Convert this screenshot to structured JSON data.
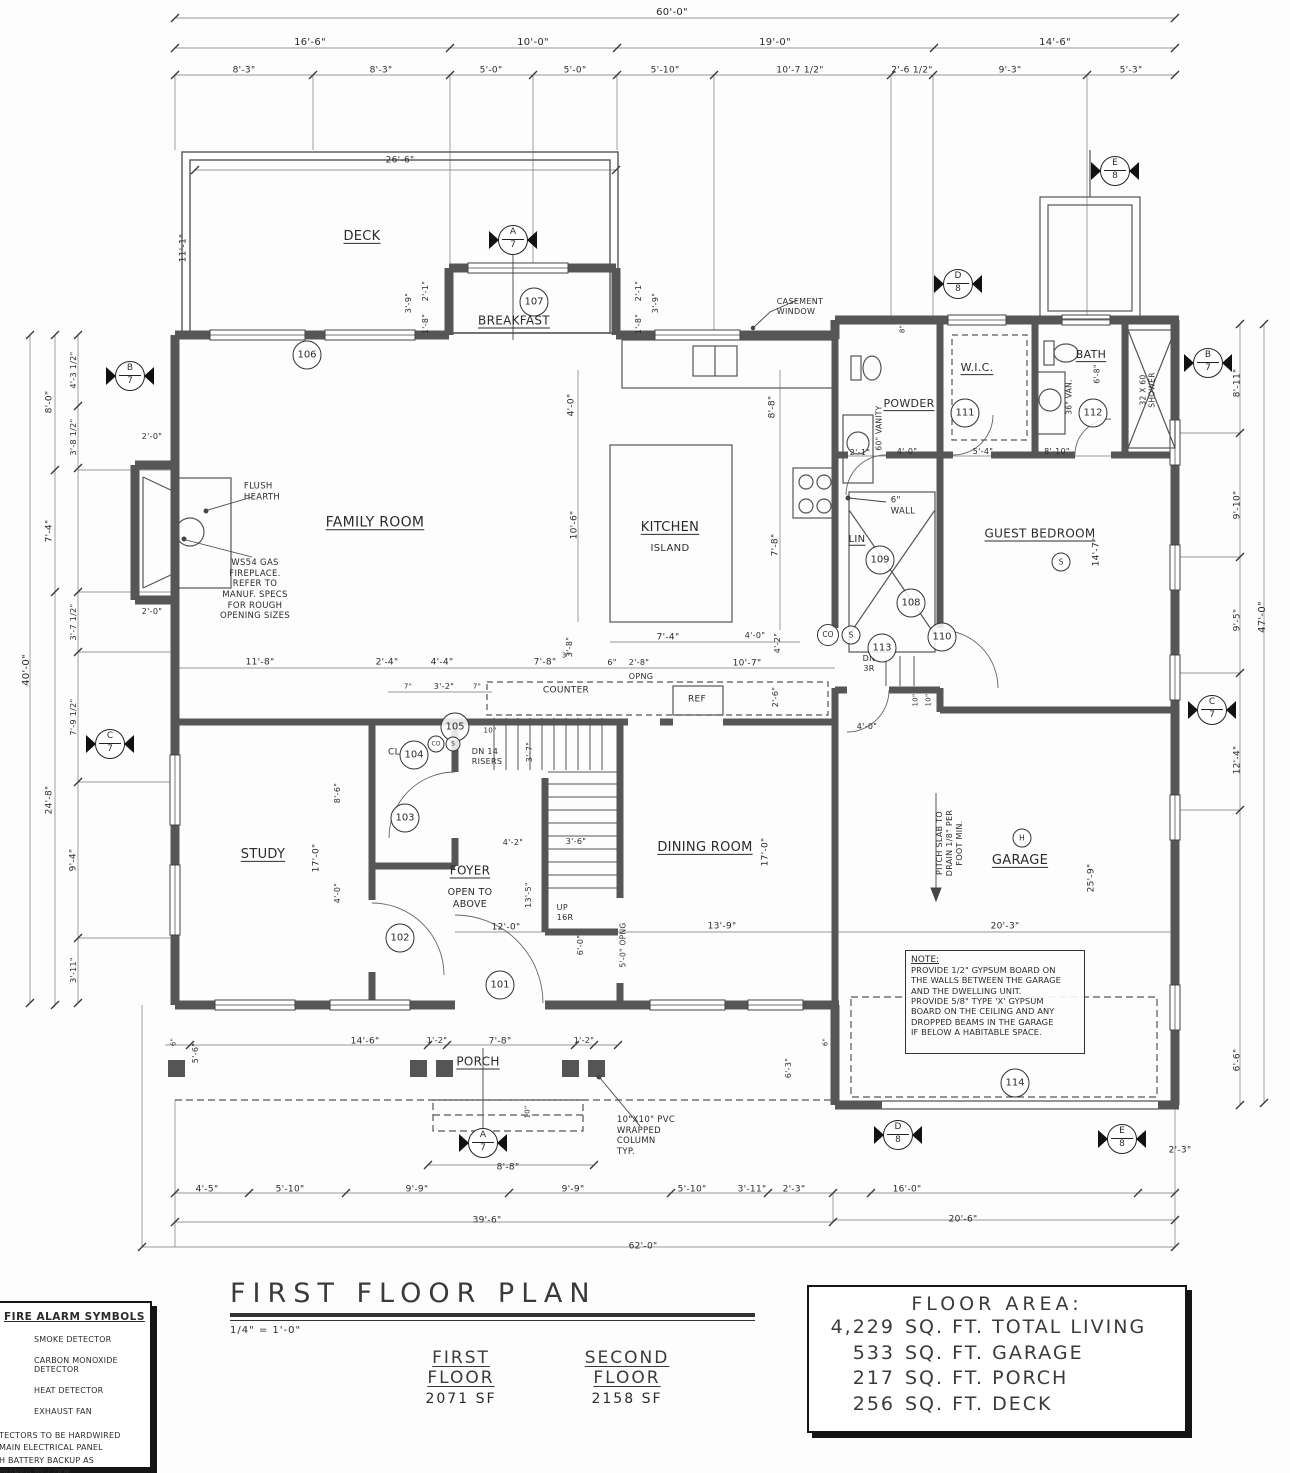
{
  "title_block": {
    "title": "FIRST FLOOR PLAN",
    "scale": "1/4\" = 1'-0\"",
    "first_floor_label": "FIRST FLOOR",
    "first_floor_area": "2071 SF",
    "second_floor_label": "SECOND FLOOR",
    "second_floor_area": "2158 SF"
  },
  "floor_area": {
    "title": "FLOOR AREA:",
    "rows": [
      {
        "qty": "4,229",
        "label": "SQ. FT. TOTAL LIVING"
      },
      {
        "qty": "533",
        "label": "SQ. FT. GARAGE"
      },
      {
        "qty": "217",
        "label": "SQ. FT. PORCH"
      },
      {
        "qty": "256",
        "label": "SQ. FT. DECK"
      }
    ]
  },
  "fire_legend": {
    "title": "FIRE ALARM SYMBOLS",
    "items": [
      "SMOKE DETECTOR",
      "CARBON MONOXIDE DETECTOR",
      "HEAT DETECTOR",
      "EXHAUST FAN"
    ],
    "note_lines": [
      "TECTORS TO BE HARDWIRED",
      " MAIN ELECTRICAL PANEL",
      "H BATTERY BACKUP AS",
      "QUIRED BY CODE."
    ]
  },
  "note_box": {
    "title": "NOTE:",
    "body": "PROVIDE 1/2\" GYPSUM BOARD ON\nTHE WALLS BETWEEN THE GARAGE\nAND THE DWELLING UNIT.\nPROVIDE 5/8\" TYPE 'X' GYPSUM\nBOARD ON THE CEILING AND ANY\nDROPPED BEAMS IN THE GARAGE\nIF BELOW A HABITABLE SPACE."
  },
  "door_tags": [
    {
      "t": "101",
      "x": 500,
      "y": 985
    },
    {
      "t": "102",
      "x": 400,
      "y": 938
    },
    {
      "t": "103",
      "x": 405,
      "y": 818
    },
    {
      "t": "104",
      "x": 414,
      "y": 755
    },
    {
      "t": "105",
      "x": 455,
      "y": 727
    },
    {
      "t": "106",
      "x": 307,
      "y": 355
    },
    {
      "t": "107",
      "x": 534,
      "y": 302
    },
    {
      "t": "108",
      "x": 911,
      "y": 603
    },
    {
      "t": "109",
      "x": 880,
      "y": 560
    },
    {
      "t": "110",
      "x": 942,
      "y": 637
    },
    {
      "t": "111",
      "x": 965,
      "y": 413
    },
    {
      "t": "112",
      "x": 1093,
      "y": 413
    },
    {
      "t": "113",
      "x": 882,
      "y": 648
    },
    {
      "t": "114",
      "x": 1015,
      "y": 1083
    }
  ],
  "symbol_tags": [
    {
      "t": "CO",
      "x": 828,
      "y": 635,
      "d": 20,
      "f": 7.5
    },
    {
      "t": "S",
      "x": 851,
      "y": 635,
      "d": 17,
      "f": 7.5
    },
    {
      "t": "S",
      "x": 1061,
      "y": 562,
      "d": 17,
      "f": 7.5
    },
    {
      "t": "H",
      "x": 1022,
      "y": 838,
      "d": 17,
      "f": 7.5
    },
    {
      "t": "CO",
      "x": 436,
      "y": 744,
      "d": 15,
      "f": 6
    },
    {
      "t": "S",
      "x": 453,
      "y": 744,
      "d": 13,
      "f": 6
    }
  ],
  "section_markers": [
    {
      "l": "A",
      "n": "7",
      "x": 513,
      "y": 240
    },
    {
      "l": "A",
      "n": "7",
      "x": 483,
      "y": 1143
    },
    {
      "l": "B",
      "n": "7",
      "x": 130,
      "y": 376
    },
    {
      "l": "B",
      "n": "7",
      "x": 1208,
      "y": 363
    },
    {
      "l": "C",
      "n": "7",
      "x": 110,
      "y": 744
    },
    {
      "l": "C",
      "n": "7",
      "x": 1212,
      "y": 710
    },
    {
      "l": "D",
      "n": "8",
      "x": 958,
      "y": 284
    },
    {
      "l": "D",
      "n": "8",
      "x": 898,
      "y": 1135
    },
    {
      "l": "E",
      "n": "8",
      "x": 1115,
      "y": 171
    },
    {
      "l": "E",
      "n": "8",
      "x": 1122,
      "y": 1139
    }
  ],
  "labels": [
    {
      "t": "60'-0\"",
      "x": 672,
      "y": 13
    },
    {
      "t": "16'-6\"",
      "x": 310,
      "y": 43
    },
    {
      "t": "10'-0\"",
      "x": 533,
      "y": 43
    },
    {
      "t": "19'-0\"",
      "x": 775,
      "y": 43
    },
    {
      "t": "14'-6\"",
      "x": 1055,
      "y": 43
    },
    {
      "t": "8'-3\"",
      "x": 244,
      "y": 71,
      "s": 9
    },
    {
      "t": "8'-3\"",
      "x": 381,
      "y": 71,
      "s": 9
    },
    {
      "t": "5'-0\"",
      "x": 491,
      "y": 71,
      "s": 9
    },
    {
      "t": "5'-0\"",
      "x": 575,
      "y": 71,
      "s": 9
    },
    {
      "t": "5'-10\"",
      "x": 665,
      "y": 71,
      "s": 9
    },
    {
      "t": "10'-7 1/2\"",
      "x": 800,
      "y": 71,
      "s": 9
    },
    {
      "t": "2'-6 1/2\"",
      "x": 912,
      "y": 71,
      "s": 9
    },
    {
      "t": "9'-3\"",
      "x": 1010,
      "y": 71,
      "s": 9
    },
    {
      "t": "5'-3\"",
      "x": 1131,
      "y": 71,
      "s": 9
    },
    {
      "t": "26'-6\"",
      "x": 400,
      "y": 161,
      "s": 9
    },
    {
      "t": "DECK",
      "x": 362,
      "y": 237,
      "s": 13,
      "u": 1
    },
    {
      "t": "11'-1\"",
      "x": 184,
      "y": 248,
      "r": -90,
      "s": 9
    },
    {
      "t": "3'-9\"",
      "x": 409,
      "y": 303,
      "r": -90,
      "s": 8
    },
    {
      "t": "2'-1\"",
      "x": 426,
      "y": 291,
      "r": -90,
      "s": 8
    },
    {
      "t": "1'-8\"",
      "x": 426,
      "y": 324,
      "r": -90,
      "s": 8
    },
    {
      "t": "2'-1\"",
      "x": 639,
      "y": 291,
      "r": -90,
      "s": 8
    },
    {
      "t": "3'-9\"",
      "x": 656,
      "y": 303,
      "r": -90,
      "s": 8
    },
    {
      "t": "1'-8\"",
      "x": 639,
      "y": 324,
      "r": -90,
      "s": 8
    },
    {
      "t": "BREAKFAST",
      "x": 514,
      "y": 321,
      "s": 12,
      "u": 1
    },
    {
      "t": "CASEMENT\nWINDOW",
      "x": 800,
      "y": 307,
      "s": 8,
      "a": "left"
    },
    {
      "t": "8\"",
      "x": 903,
      "y": 329,
      "r": -90,
      "s": 7
    },
    {
      "t": "4'-3 1/2\"",
      "x": 74,
      "y": 370,
      "r": -90,
      "s": 8
    },
    {
      "t": "8'-0\"",
      "x": 50,
      "y": 402,
      "r": -90,
      "s": 9
    },
    {
      "t": "3'-8 1/2\"",
      "x": 74,
      "y": 437,
      "r": -90,
      "s": 8
    },
    {
      "t": "7'-4\"",
      "x": 50,
      "y": 531,
      "r": -90,
      "s": 9
    },
    {
      "t": "3'-7 1/2\"",
      "x": 74,
      "y": 622,
      "r": -90,
      "s": 8
    },
    {
      "t": "7'-9 1/2\"",
      "x": 74,
      "y": 717,
      "r": -90,
      "s": 8
    },
    {
      "t": "24'-8\"",
      "x": 50,
      "y": 800,
      "r": -90,
      "s": 9
    },
    {
      "t": "9'-4\"",
      "x": 74,
      "y": 860,
      "r": -90,
      "s": 9
    },
    {
      "t": "3'-11\"",
      "x": 74,
      "y": 970,
      "r": -90,
      "s": 8
    },
    {
      "t": "40'-0\"",
      "x": 27,
      "y": 670,
      "r": -90,
      "s": 10
    },
    {
      "t": "2'-0\"",
      "x": 152,
      "y": 437,
      "s": 8
    },
    {
      "t": "2'-0\"",
      "x": 152,
      "y": 612,
      "s": 8
    },
    {
      "t": "FAMILY ROOM",
      "x": 375,
      "y": 523,
      "s": 14,
      "u": 1
    },
    {
      "t": "FLUSH\nHEARTH",
      "x": 262,
      "y": 492,
      "s": 8.5,
      "a": "left"
    },
    {
      "t": "WS54 GAS\nFIREPLACE.\nREFER TO\nMANUF. SPECS\nFOR ROUGH\nOPENING SIZES",
      "x": 255,
      "y": 590,
      "s": 8.5
    },
    {
      "t": "11'-8\"",
      "x": 260,
      "y": 663,
      "s": 9
    },
    {
      "t": "2'-4\"",
      "x": 387,
      "y": 663,
      "s": 9
    },
    {
      "t": "4'-4\"",
      "x": 442,
      "y": 663,
      "s": 9
    },
    {
      "t": "7'-8\"",
      "x": 545,
      "y": 663,
      "s": 9
    },
    {
      "t": "3\"",
      "x": 566,
      "y": 656,
      "s": 7
    },
    {
      "t": "6\"",
      "x": 612,
      "y": 663,
      "s": 8
    },
    {
      "t": "2'-8\"",
      "x": 639,
      "y": 663,
      "s": 8
    },
    {
      "t": "OPNG",
      "x": 641,
      "y": 677,
      "s": 8
    },
    {
      "t": "10'-7\"",
      "x": 747,
      "y": 664,
      "s": 9
    },
    {
      "t": "2'-6\"",
      "x": 776,
      "y": 697,
      "r": -90,
      "s": 8
    },
    {
      "t": "7\"",
      "x": 408,
      "y": 687,
      "s": 7
    },
    {
      "t": "3'-2\"",
      "x": 444,
      "y": 687,
      "s": 8
    },
    {
      "t": "7\"",
      "x": 477,
      "y": 687,
      "s": 7
    },
    {
      "t": "COUNTER",
      "x": 566,
      "y": 691,
      "s": 9
    },
    {
      "t": "KITCHEN",
      "x": 670,
      "y": 528,
      "s": 13,
      "u": 1
    },
    {
      "t": "ISLAND",
      "x": 670,
      "y": 549,
      "s": 10
    },
    {
      "t": "4'-0\"",
      "x": 572,
      "y": 405,
      "r": -90,
      "s": 9
    },
    {
      "t": "10'-6\"",
      "x": 575,
      "y": 525,
      "r": -90,
      "s": 9
    },
    {
      "t": "3'-8\"",
      "x": 570,
      "y": 647,
      "r": -90,
      "s": 8
    },
    {
      "t": "7'-4\"",
      "x": 668,
      "y": 638,
      "s": 9
    },
    {
      "t": "4'-0\"",
      "x": 755,
      "y": 636,
      "s": 8
    },
    {
      "t": "4'-2\"",
      "x": 778,
      "y": 643,
      "r": -90,
      "s": 8
    },
    {
      "t": "8'-8\"",
      "x": 773,
      "y": 407,
      "r": -90,
      "s": 9
    },
    {
      "t": "7'-8\"",
      "x": 776,
      "y": 545,
      "r": -90,
      "s": 9
    },
    {
      "t": "6\"\nWALL",
      "x": 903,
      "y": 506,
      "s": 8.5,
      "a": "left"
    },
    {
      "t": "LIN",
      "x": 857,
      "y": 540,
      "s": 10,
      "u": 1
    },
    {
      "t": "DN\n3R",
      "x": 869,
      "y": 664,
      "s": 8
    },
    {
      "t": "REF",
      "x": 697,
      "y": 700,
      "s": 9
    },
    {
      "t": "POWDER",
      "x": 909,
      "y": 404,
      "s": 11,
      "u": 1
    },
    {
      "t": "60\" VANITY",
      "x": 879,
      "y": 428,
      "r": -90,
      "s": 7.5
    },
    {
      "t": "2'-1\"",
      "x": 860,
      "y": 453,
      "s": 8
    },
    {
      "t": "4'-0\"",
      "x": 907,
      "y": 452,
      "s": 8
    },
    {
      "t": "W.I.C.",
      "x": 977,
      "y": 368,
      "s": 11,
      "u": 1
    },
    {
      "t": "5'-4\"",
      "x": 983,
      "y": 452,
      "s": 8
    },
    {
      "t": "8'-10\"",
      "x": 1057,
      "y": 452,
      "s": 8
    },
    {
      "t": "BATH",
      "x": 1091,
      "y": 355,
      "s": 11,
      "u": 1
    },
    {
      "t": "36\" VAN.",
      "x": 1069,
      "y": 397,
      "r": -90,
      "s": 7.5
    },
    {
      "t": "6'-8\"",
      "x": 1097,
      "y": 374,
      "r": -90,
      "s": 7.5
    },
    {
      "t": "32 X 60\nSHOWER",
      "x": 1148,
      "y": 390,
      "r": -90,
      "s": 7.5
    },
    {
      "t": "GUEST BEDROOM",
      "x": 1040,
      "y": 534,
      "s": 12,
      "u": 1
    },
    {
      "t": "14'-7\"",
      "x": 1097,
      "y": 552,
      "r": -90,
      "s": 9
    },
    {
      "t": "8'-11\"",
      "x": 1238,
      "y": 383,
      "r": -90,
      "s": 9
    },
    {
      "t": "9'-10\"",
      "x": 1238,
      "y": 505,
      "r": -90,
      "s": 9
    },
    {
      "t": "9'-5\"",
      "x": 1238,
      "y": 620,
      "r": -90,
      "s": 9
    },
    {
      "t": "12'-4\"",
      "x": 1238,
      "y": 760,
      "r": -90,
      "s": 9
    },
    {
      "t": "6'-6\"",
      "x": 1238,
      "y": 1060,
      "r": -90,
      "s": 9
    },
    {
      "t": "47'-0\"",
      "x": 1263,
      "y": 617,
      "r": -90,
      "s": 10
    },
    {
      "t": "2'-3\"",
      "x": 1180,
      "y": 1151,
      "s": 9
    },
    {
      "t": "4'-0\"",
      "x": 867,
      "y": 727,
      "s": 8
    },
    {
      "t": "10\"",
      "x": 916,
      "y": 700,
      "r": -90,
      "s": 7
    },
    {
      "t": "10\"",
      "x": 929,
      "y": 700,
      "r": -90,
      "s": 7
    },
    {
      "t": "10\"",
      "x": 490,
      "y": 731,
      "s": 7
    },
    {
      "t": "DN 14\nRISERS",
      "x": 487,
      "y": 757,
      "s": 8,
      "a": "left"
    },
    {
      "t": "3'-7\"",
      "x": 530,
      "y": 752,
      "r": -90,
      "s": 8
    },
    {
      "t": "CL",
      "x": 394,
      "y": 753,
      "s": 9
    },
    {
      "t": "STUDY",
      "x": 263,
      "y": 855,
      "s": 13,
      "u": 1
    },
    {
      "t": "17'-0\"",
      "x": 317,
      "y": 858,
      "r": -90,
      "s": 9
    },
    {
      "t": "8'-6\"",
      "x": 338,
      "y": 793,
      "r": -90,
      "s": 8
    },
    {
      "t": "4'-0\"",
      "x": 338,
      "y": 893,
      "r": -90,
      "s": 8
    },
    {
      "t": "4'-2\"",
      "x": 513,
      "y": 843,
      "s": 8
    },
    {
      "t": "3'-6\"",
      "x": 576,
      "y": 842,
      "s": 8
    },
    {
      "t": "FOYER",
      "x": 470,
      "y": 871,
      "s": 12,
      "u": 1
    },
    {
      "t": "OPEN TO\nABOVE",
      "x": 470,
      "y": 899,
      "s": 9.5
    },
    {
      "t": "13'-5\"",
      "x": 529,
      "y": 895,
      "r": -90,
      "s": 8
    },
    {
      "t": "UP\n16R",
      "x": 565,
      "y": 913,
      "s": 8,
      "a": "left"
    },
    {
      "t": "12'-0\"",
      "x": 506,
      "y": 928,
      "s": 9
    },
    {
      "t": "6'-0\"",
      "x": 581,
      "y": 945,
      "r": -90,
      "s": 8
    },
    {
      "t": "5'-0\" OPNG",
      "x": 623,
      "y": 945,
      "r": -90,
      "s": 7.5
    },
    {
      "t": "DINING ROOM",
      "x": 705,
      "y": 848,
      "s": 13,
      "u": 1
    },
    {
      "t": "17'-0\"",
      "x": 766,
      "y": 852,
      "r": -90,
      "s": 9
    },
    {
      "t": "13'-9\"",
      "x": 722,
      "y": 927,
      "s": 9
    },
    {
      "t": "GARAGE",
      "x": 1020,
      "y": 861,
      "s": 13,
      "u": 1
    },
    {
      "t": "20'-3\"",
      "x": 1005,
      "y": 927,
      "s": 9
    },
    {
      "t": "25'-9\"",
      "x": 1092,
      "y": 878,
      "r": -90,
      "s": 9
    },
    {
      "t": "PITCH SLAB TO\nDRAIN 1/8\" PER\nFOOT MIN.",
      "x": 950,
      "y": 843,
      "r": -90,
      "s": 8
    },
    {
      "t": "6'-3\"",
      "x": 789,
      "y": 1068,
      "r": -90,
      "s": 8
    },
    {
      "t": "6\"",
      "x": 826,
      "y": 1042,
      "r": -90,
      "s": 7
    },
    {
      "t": "PORCH",
      "x": 478,
      "y": 1062,
      "s": 12,
      "u": 1
    },
    {
      "t": "14'-6\"",
      "x": 365,
      "y": 1042,
      "s": 9
    },
    {
      "t": "1'-2\"",
      "x": 437,
      "y": 1041,
      "s": 8
    },
    {
      "t": "7'-8\"",
      "x": 500,
      "y": 1042,
      "s": 9
    },
    {
      "t": "1'-2\"",
      "x": 584,
      "y": 1041,
      "s": 8
    },
    {
      "t": "6\"",
      "x": 174,
      "y": 1042,
      "r": -90,
      "s": 7
    },
    {
      "t": "5'-6\"",
      "x": 196,
      "y": 1053,
      "r": -90,
      "s": 8
    },
    {
      "t": "10\"",
      "x": 528,
      "y": 1112,
      "r": -90,
      "s": 7
    },
    {
      "t": "10\"X10\" PVC\nWRAPPED\nCOLUMN\nTYP.",
      "x": 646,
      "y": 1136,
      "s": 8.5,
      "a": "left"
    },
    {
      "t": "8'-8\"",
      "x": 508,
      "y": 1168,
      "s": 9
    },
    {
      "t": "4'-5\"",
      "x": 207,
      "y": 1190,
      "s": 9
    },
    {
      "t": "5'-10\"",
      "x": 290,
      "y": 1190,
      "s": 9
    },
    {
      "t": "9'-9\"",
      "x": 417,
      "y": 1190,
      "s": 9
    },
    {
      "t": "9'-9\"",
      "x": 573,
      "y": 1190,
      "s": 9
    },
    {
      "t": "5'-10\"",
      "x": 692,
      "y": 1190,
      "s": 9
    },
    {
      "t": "3'-11\"",
      "x": 752,
      "y": 1190,
      "s": 9
    },
    {
      "t": "2'-3\"",
      "x": 794,
      "y": 1190,
      "s": 9
    },
    {
      "t": "16'-0\"",
      "x": 907,
      "y": 1190,
      "s": 9
    },
    {
      "t": "39'-6\"",
      "x": 487,
      "y": 1221,
      "s": 9
    },
    {
      "t": "20'-6\"",
      "x": 963,
      "y": 1220,
      "s": 9
    },
    {
      "t": "62'-0\"",
      "x": 643,
      "y": 1247,
      "s": 9
    }
  ]
}
